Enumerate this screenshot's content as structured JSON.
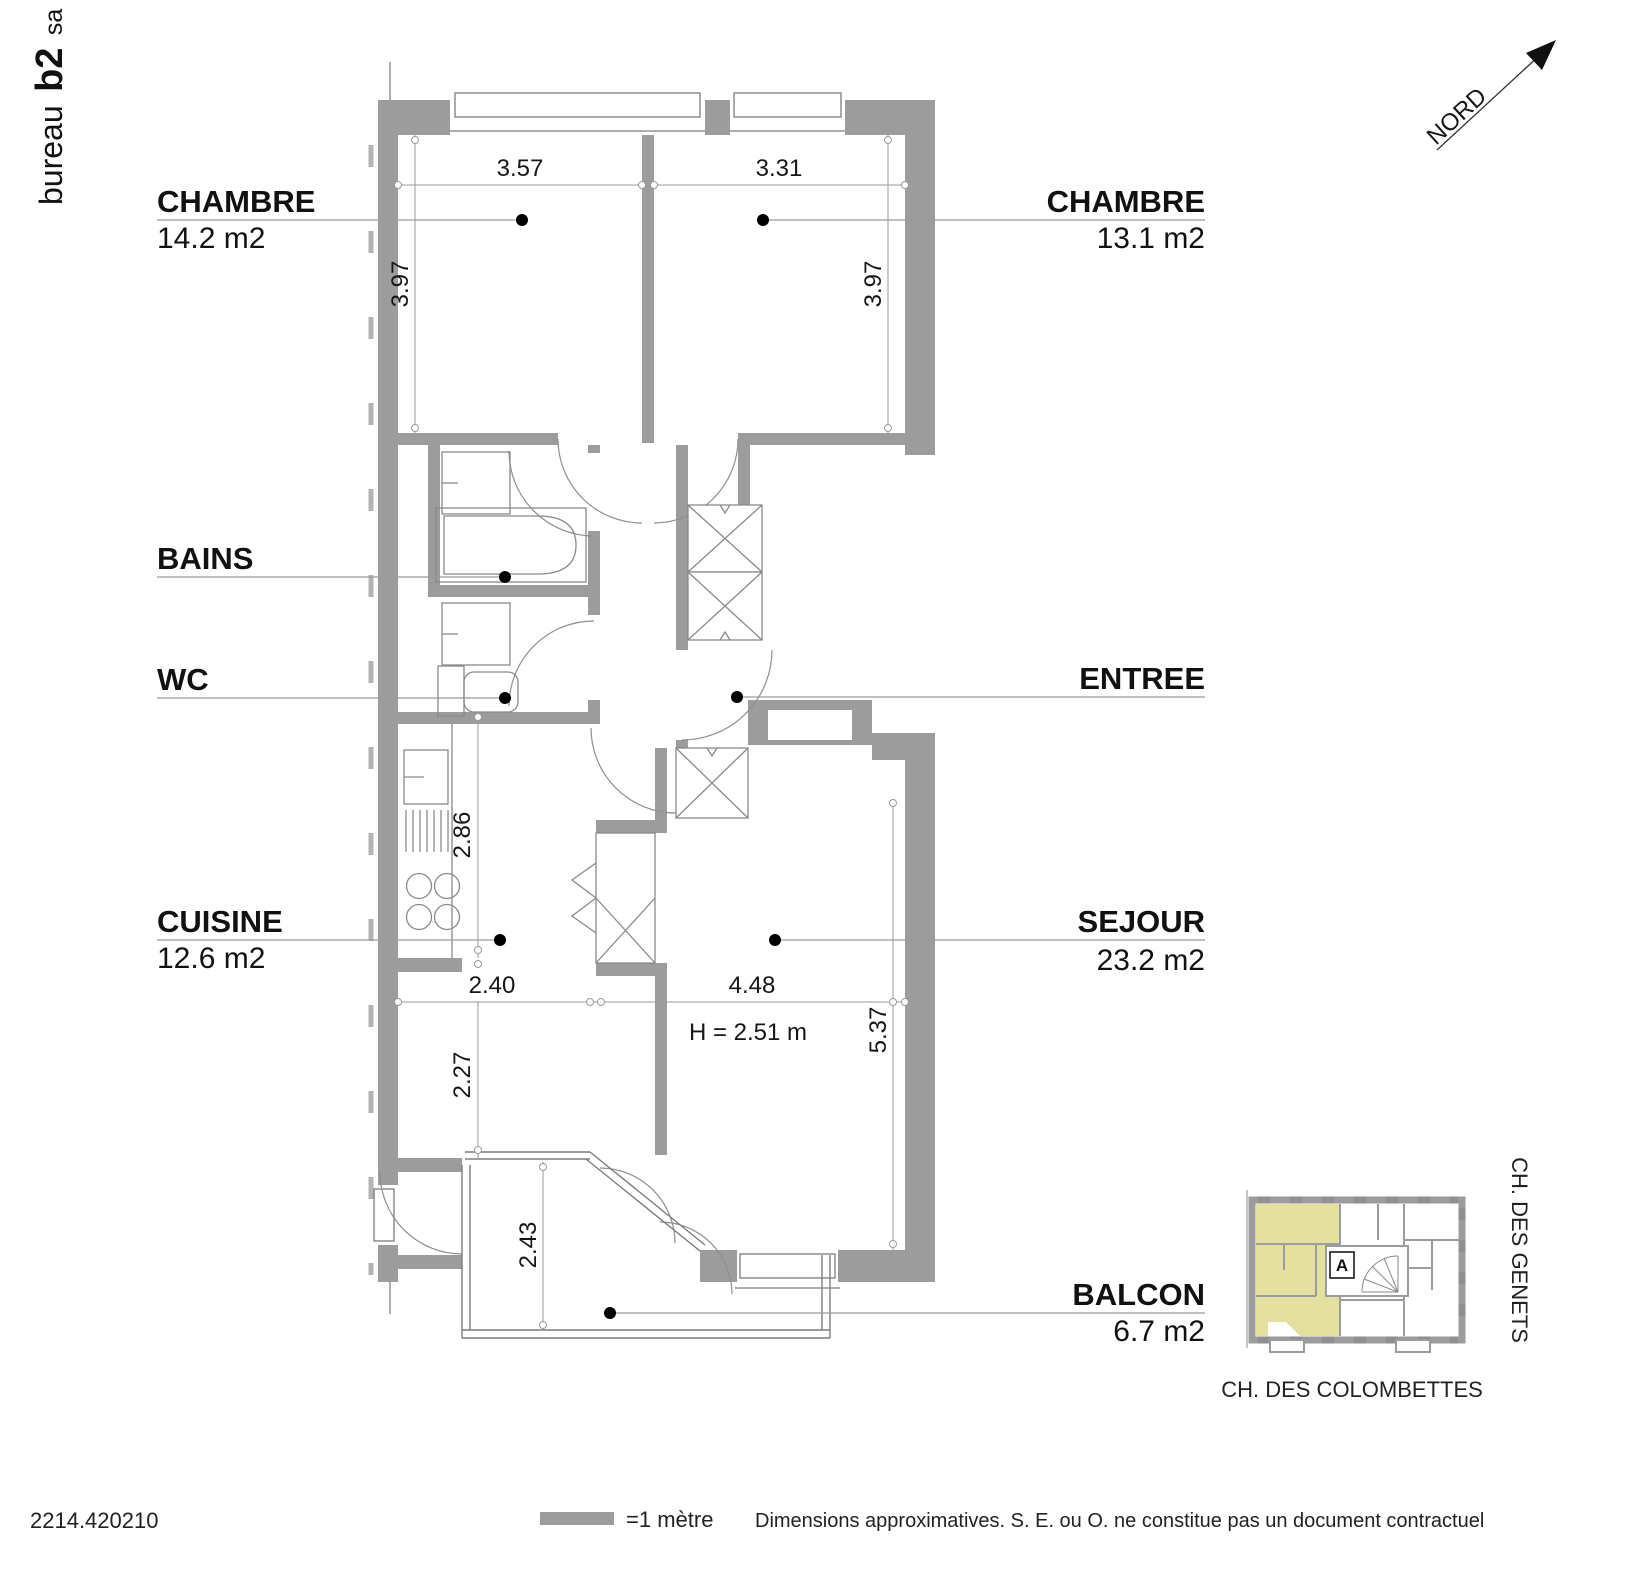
{
  "brand": {
    "prefix": "bureau",
    "bold": "b2",
    "suffix": "sa"
  },
  "north_label": "NORD",
  "rooms": {
    "chambre1": {
      "name": "CHAMBRE",
      "area": "14.2 m2"
    },
    "chambre2": {
      "name": "CHAMBRE",
      "area": "13.1 m2"
    },
    "bains": {
      "name": "BAINS"
    },
    "wc": {
      "name": "WC"
    },
    "entree": {
      "name": "ENTREE"
    },
    "cuisine": {
      "name": "CUISINE",
      "area": "12.6 m2"
    },
    "sejour": {
      "name": "SEJOUR",
      "area": "23.2 m2"
    },
    "balcon": {
      "name": "BALCON",
      "area": "6.7 m2"
    }
  },
  "dimensions": {
    "chambre1_width": "3.57",
    "chambre2_width": "3.31",
    "chambre1_depth": "3.97",
    "chambre2_depth": "3.97",
    "cuisine_depth": "2.86",
    "cuisine_width": "2.40",
    "sejour_width": "4.48",
    "cuisine_lower_depth": "2.27",
    "sejour_depth": "5.37",
    "balcon_depth": "2.43",
    "ceiling_height": "H = 2.51 m"
  },
  "inset": {
    "unit_label": "A",
    "street_right": "CH. DES GENETS",
    "street_bottom": "CH. DES COLOMBETTES",
    "highlight_color": "#e3e0a0"
  },
  "footer": {
    "reference": "2214.420210",
    "scale_label": "=1 mètre",
    "disclaimer": "Dimensions approximatives. S. E. ou O. ne constitue pas un document contractuel"
  },
  "colors": {
    "wall": "#9c9c9c"
  }
}
